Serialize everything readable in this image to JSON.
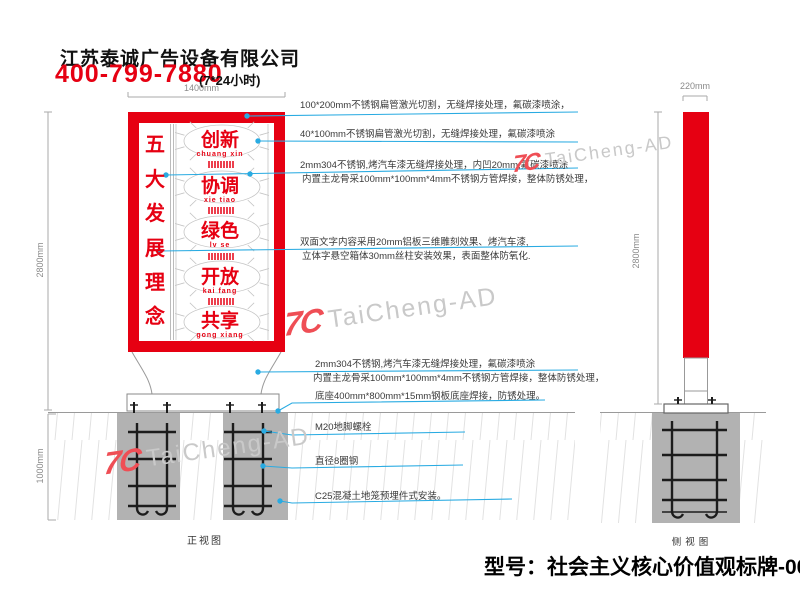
{
  "header": {
    "company": "江苏泰诚广告设备有限公司",
    "phone": "400-799-7880",
    "hours": "(7*24小时)"
  },
  "watermark": {
    "logo": "7C",
    "text": "TaiCheng-AD"
  },
  "dimensions": {
    "sign_width": "1400mm",
    "total_height": "2800mm",
    "foundation_depth": "1000mm",
    "side_width": "220mm",
    "side_height": "2800mm"
  },
  "sign": {
    "slogan": [
      "五",
      "大",
      "发",
      "展",
      "理",
      "念"
    ],
    "values": [
      {
        "word": "创新",
        "pinyin": "chuang xin"
      },
      {
        "word": "协调",
        "pinyin": "xie tiao"
      },
      {
        "word": "绿色",
        "pinyin": "lv se"
      },
      {
        "word": "开放",
        "pinyin": "kai fang"
      },
      {
        "word": "共享",
        "pinyin": "gong xiang"
      }
    ]
  },
  "annotations": [
    {
      "lines": [
        "100*200mm不锈钢扁管激光切割，无缝焊接处理，氟碳漆喷涂，"
      ]
    },
    {
      "lines": [
        "40*100mm不锈钢扁管激光切割，无缝焊接处理，氟碳漆喷涂"
      ]
    },
    {
      "lines": [
        "2mm304不锈钢,烤汽车漆无缝焊接处理，内凹20mm,氟碳漆喷涂",
        "内置主龙骨采100mm*100mm*4mm不锈钢方管焊接，整体防锈处理，"
      ]
    },
    {
      "lines": [
        "双面文字内容采用20mm铝板三维雕刻效果、烤汽车漆,",
        "立体字悬空箱体30mm丝柱安装效果，表面整体防氧化."
      ]
    },
    {
      "lines": [
        "2mm304不锈钢,烤汽车漆无缝焊接处理，氟碳漆喷涂",
        "内置主龙骨采100mm*100mm*4mm不锈钢方管焊接，整体防锈处理，"
      ]
    },
    {
      "lines": [
        "底座400mm*800mm*15mm钢板底座焊接，防锈处理。"
      ]
    },
    {
      "lines": [
        "M20地脚螺栓"
      ]
    },
    {
      "lines": [
        "直径8圈钢"
      ]
    },
    {
      "lines": [
        "C25混凝土地笼预埋件式安装。"
      ]
    }
  ],
  "views": {
    "front": "正视图",
    "side": "侧视图"
  },
  "model": "型号：社会主义核心价值观标牌-0080",
  "colors": {
    "red": "#e60012",
    "blue": "#29abe2",
    "foundation_gray": "#b2b2b2",
    "watermark_gray": "#c9c9c9"
  }
}
